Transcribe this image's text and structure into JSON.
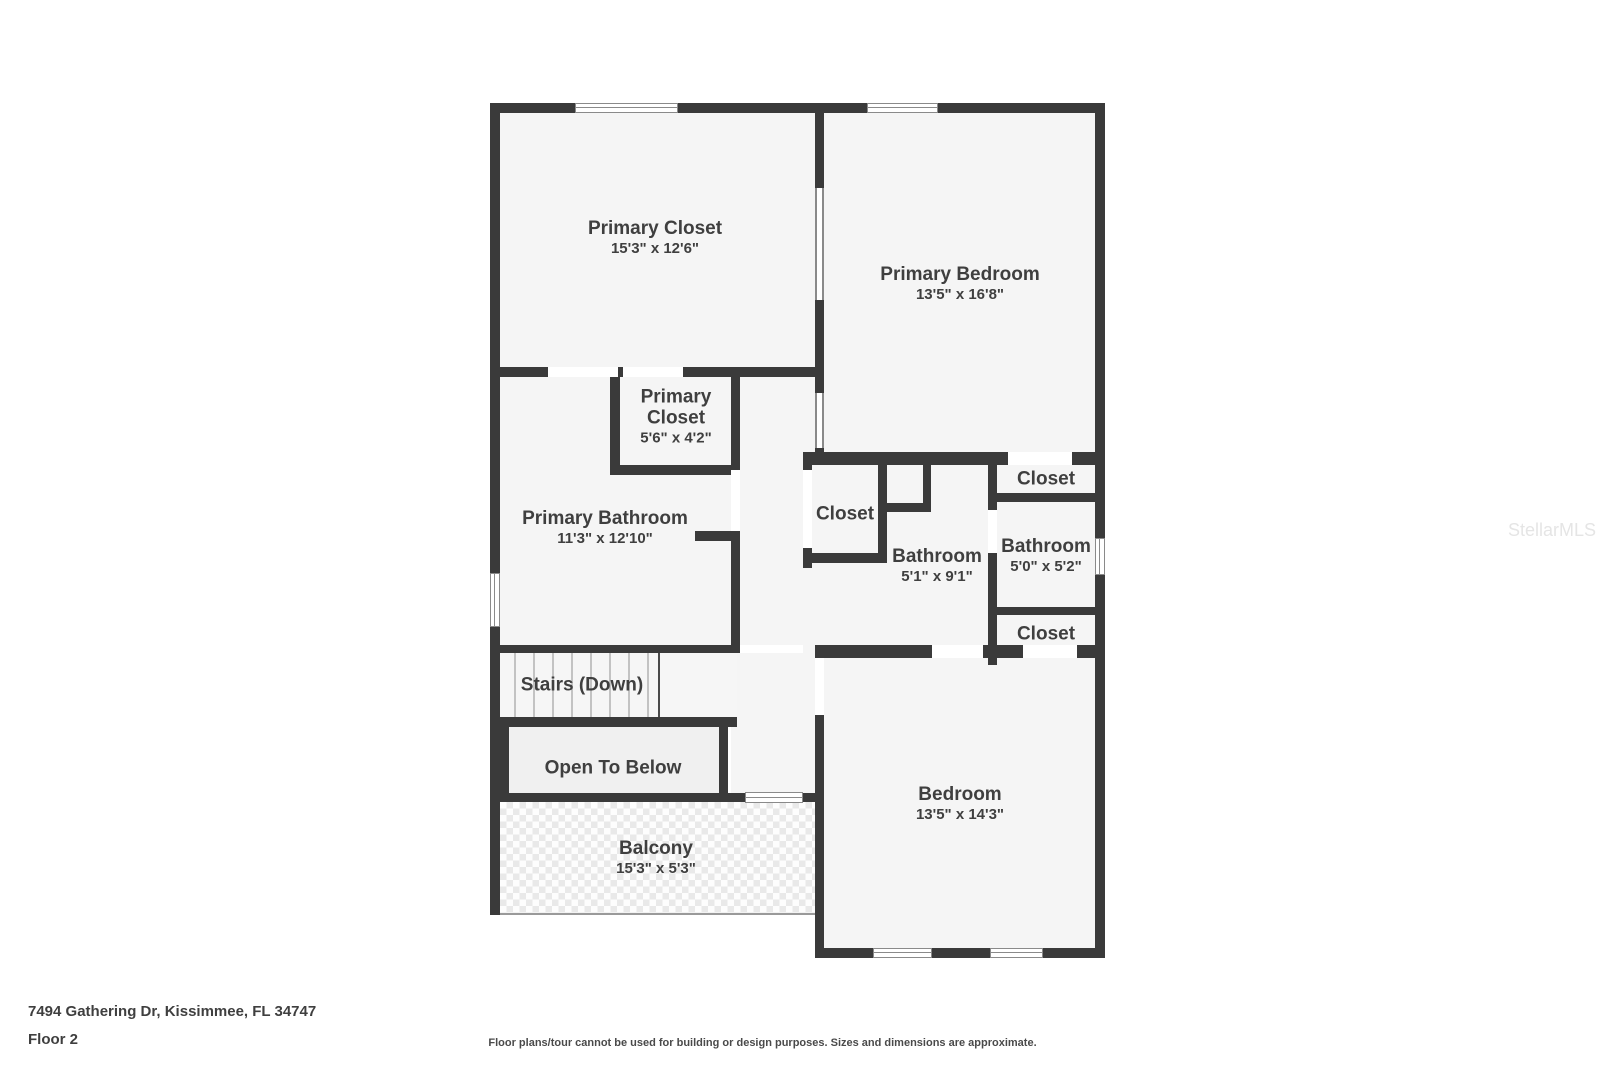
{
  "floorplan": {
    "watermark": "StellarMLS",
    "rooms": [
      {
        "name": "Primary Closet",
        "dims": "15'3\" x 12'6\""
      },
      {
        "name": "Primary Bedroom",
        "dims": "13'5\" x 16'8\""
      },
      {
        "name": "Primary Closet",
        "dims": "5'6\" x 4'2\""
      },
      {
        "name": "Primary Bathroom",
        "dims": "11'3\" x 12'10\""
      },
      {
        "name": "Closet",
        "dims": ""
      },
      {
        "name": "Bathroom",
        "dims": "5'1\" x 9'1\""
      },
      {
        "name": "Closet",
        "dims": ""
      },
      {
        "name": "Bathroom",
        "dims": "5'0\" x 5'2\""
      },
      {
        "name": "Closet",
        "dims": ""
      },
      {
        "name": "Stairs (Down)",
        "dims": ""
      },
      {
        "name": "Open To Below",
        "dims": ""
      },
      {
        "name": "Balcony",
        "dims": "15'3\" x 5'3\""
      },
      {
        "name": "Bedroom",
        "dims": "13'5\" x 14'3\""
      }
    ],
    "colors": {
      "wall": "#3a3a3a",
      "room_fill": "#f5f5f5",
      "text": "#3f3f3f"
    }
  },
  "footer": {
    "address": "7494 Gathering Dr, Kissimmee, FL 34747",
    "floor": "Floor 2",
    "disclaimer": "Floor plans/tour cannot be used for building or design purposes. Sizes and dimensions are approximate."
  }
}
